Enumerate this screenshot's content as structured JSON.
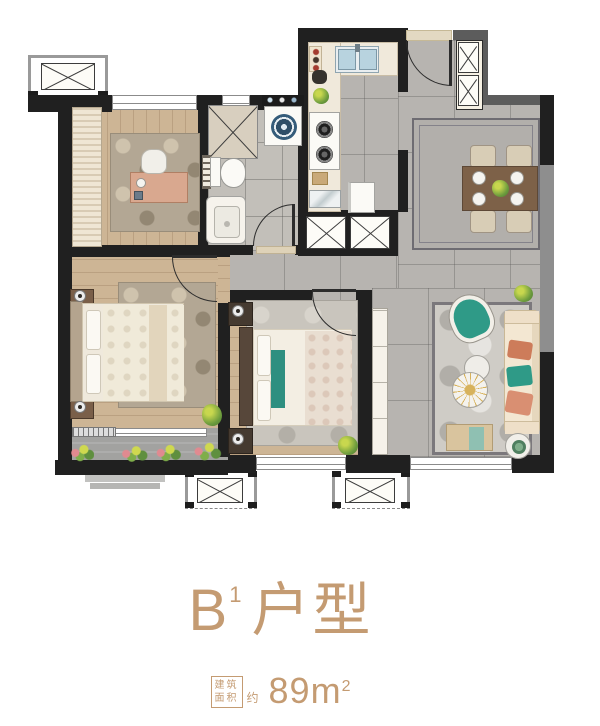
{
  "card": {
    "title": {
      "letter": "B",
      "sup": "1",
      "suffix": "户型"
    },
    "area": {
      "badge_line1": "建筑",
      "badge_line2": "面积",
      "approx": "约",
      "value": "89",
      "unit": "m",
      "unit_sup": "2"
    }
  },
  "colors": {
    "accent": "#c49b72",
    "wall": "#202020",
    "wall_gray": "#5c5c5c",
    "shared_gray": "#8e8e8e",
    "wood": "#cdb595",
    "tile": "#b7b4b0",
    "bath_tile": "#c2bfb9",
    "balcony_stone": "#a2a2a0",
    "counter": "#f0e9db",
    "rug_tan": "#b3a794",
    "teal": "#2f9a87",
    "orange": "#cd7c5a",
    "sofa_cream": "#f3e7d2",
    "table_brown": "#7d6148"
  }
}
